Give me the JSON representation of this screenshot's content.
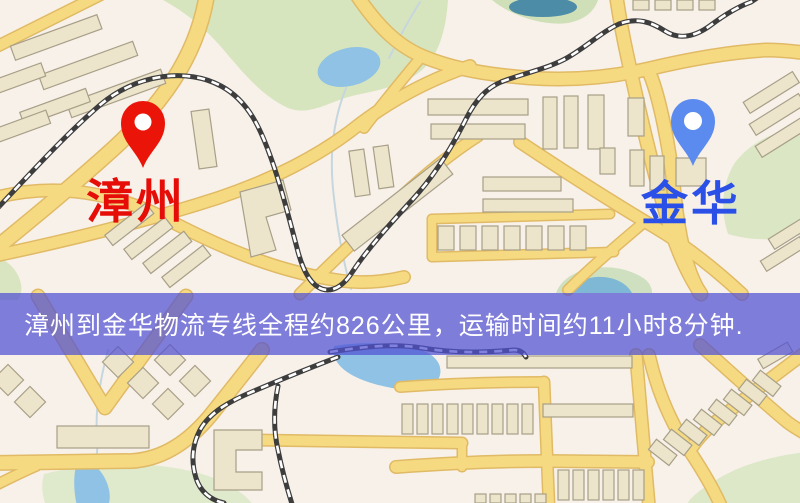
{
  "map": {
    "markers": {
      "origin": {
        "label": "漳州",
        "pin_color": "#ea1508",
        "label_color": "#e60d08"
      },
      "destination": {
        "label": "金华",
        "pin_color": "#5b8bee",
        "label_color": "#2b50e8"
      }
    },
    "banner": {
      "text": "漳州到金华物流专线全程约826公里，运输时间约11小时8分钟.",
      "bg_color": "#5050d4",
      "text_color": "#ffffff"
    }
  },
  "palette": {
    "background": "#f8f1ea",
    "road": "#f6da82",
    "road_casing": "#e0ba65",
    "road_orange": "#efc168",
    "building": "#ece4cb",
    "green_area": "#d7e5bf",
    "water": "#8fc2e4",
    "pond_dark": "#4d8ca6",
    "railway": "#3d3d3d"
  }
}
